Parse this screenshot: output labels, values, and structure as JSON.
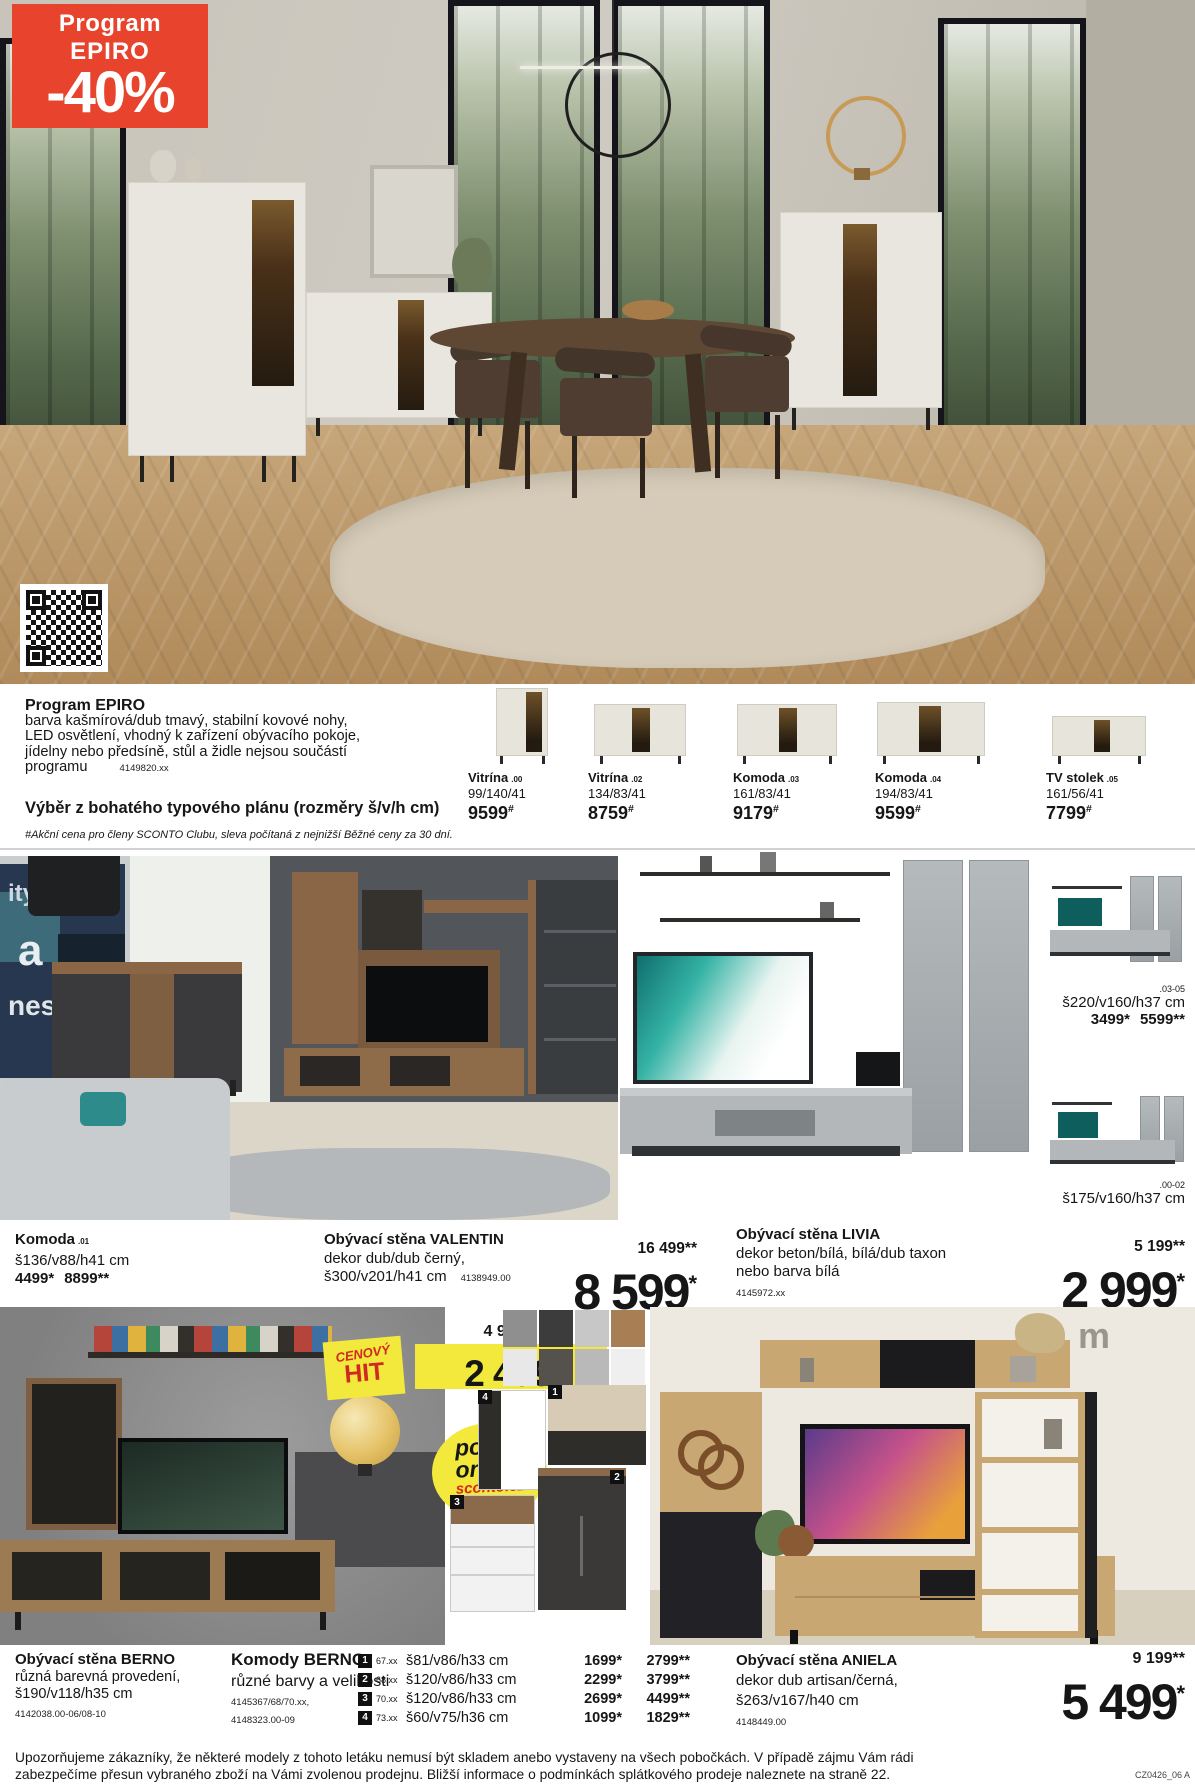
{
  "colors": {
    "accent_red": "#e8432c",
    "badge_yellow": "#f3e93c",
    "hit_red": "#cf2a22",
    "divider_grey": "#d2d2d2"
  },
  "badge": {
    "line1": "Program",
    "line2": "EPIRO",
    "discount": "-40%"
  },
  "program": {
    "title": "Program EPIRO",
    "desc_line1": "barva kašmírová/dub tmavý, stabilní kovové nohy,",
    "desc_line2": "LED osvětlení, vhodný k zařízení obývacího pokoje,",
    "desc_line3": "jídelny nebo předsíně, stůl a židle nejsou součástí",
    "desc_line4": "programu",
    "item_number": "4149820.xx",
    "subtitle": "Výběr z bohatého typového plánu (rozměry š/v/h cm)",
    "note": "#Akční cena pro členy SCONTO Clubu, sleva počítaná z nejnižší Běžné ceny za 30 dní."
  },
  "program_products": [
    {
      "name": "Vitrína",
      "variant": ".00",
      "dims": "99/140/41",
      "price": "9599",
      "sup": "#"
    },
    {
      "name": "Vitrína",
      "variant": ".02",
      "dims": "134/83/41",
      "price": "8759",
      "sup": "#"
    },
    {
      "name": "Komoda",
      "variant": ".03",
      "dims": "161/83/41",
      "price": "9179",
      "sup": "#"
    },
    {
      "name": "Komoda",
      "variant": ".04",
      "dims": "194/83/41",
      "price": "9599",
      "sup": "#"
    },
    {
      "name": "TV stolek",
      "variant": ".05",
      "dims": "161/56/41",
      "price": "7799",
      "sup": "#"
    }
  ],
  "middle": {
    "poster": {
      "l1": "ity",
      "l2": "a",
      "l3": "nes"
    },
    "komoda01": {
      "name": "Komoda",
      "variant": ".01",
      "dims": "š136/v88/h41 cm",
      "price_club": "4499*",
      "price_regular": "8899**"
    },
    "valentin": {
      "name": "Obývací stěna VALENTIN",
      "desc": "dekor dub/dub černý,",
      "dims": "š300/v201/h41 cm",
      "item_number": "4138949.00",
      "price_old": "16 499**",
      "price": "8 599",
      "price_sup": "*"
    },
    "livia": {
      "name": "Obývací stěna LIVIA",
      "desc1": "dekor beton/bílá, bílá/dub taxon",
      "desc2": "nebo barva bílá",
      "item_number": "4145972.xx",
      "price_old": "5 199**",
      "price": "2 999",
      "price_sup": "*"
    },
    "livia_top": {
      "code": ".03-05",
      "dims": "š220/v160/h37 cm",
      "price_club": "3499*",
      "price_regular": "5599**"
    },
    "livia_bottom": {
      "code": ".00-02",
      "dims": "š175/v160/h37 cm"
    }
  },
  "hit": {
    "old_price": "4 999**",
    "price": "2 499",
    "price_sup": "*",
    "badge_line1": "CENOVÝ",
    "badge_line2": "HIT"
  },
  "online_badge": {
    "line1": "pouze",
    "line2": "online",
    "line3": "sconto.cz"
  },
  "bottom": {
    "berno_wall": {
      "name": "Obývací stěna BERNO",
      "desc": "různá barevná provedení,",
      "dims": "š190/v118/h35 cm",
      "item_number": "4142038.00-06/08-10"
    },
    "berno_komody": {
      "name": "Komody BERNO",
      "desc": "různé barvy a velikosti",
      "item_numbers1": "4145367/68/70.xx,",
      "item_numbers2": "4148323.00-09",
      "rows": [
        {
          "num": "1",
          "code": "67.xx",
          "dims": "š81/v86/h33 cm",
          "price_club": "1699*",
          "price_regular": "2799**"
        },
        {
          "num": "2",
          "code": "68.xx",
          "dims": "š120/v86/h33 cm",
          "price_club": "2299*",
          "price_regular": "3799**"
        },
        {
          "num": "3",
          "code": "70.xx",
          "dims": "š120/v86/h33 cm",
          "price_club": "2699*",
          "price_regular": "4499**"
        },
        {
          "num": "4",
          "code": "73.xx",
          "dims": "š60/v75/h36 cm",
          "price_club": "1099*",
          "price_regular": "1829**"
        }
      ]
    },
    "aniela": {
      "name": "Obývací stěna ANIELA",
      "desc": "dekor dub artisan/černá,",
      "dims": "š263/v167/h40 cm",
      "item_number": "4148449.00",
      "price_old": "9 199**",
      "price": "5 499",
      "price_sup": "*",
      "decor_letter": "m"
    }
  },
  "footer": {
    "line1": "Upozorňujeme zákazníky, že některé modely z tohoto letáku nemusí být skladem anebo vystaveny na všech pobočkách. V případě zájmu Vám rádi",
    "line2": "zabezpečíme přesun vybraného zboží na Vámi zvolenou prodejnu. Bližší informace o podmínkách splátkového prodeje naleznete na straně 22.",
    "code": "CZ0426_06 A"
  }
}
